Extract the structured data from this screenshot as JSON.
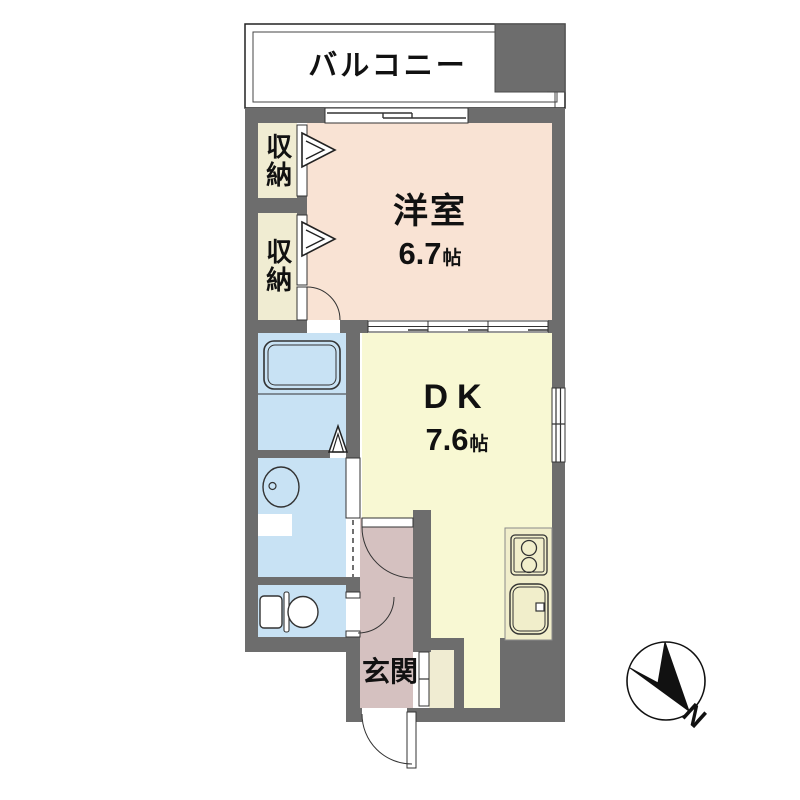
{
  "plan": {
    "type_note": "apartment floor plan",
    "balcony": {
      "label": "バルコニー"
    },
    "storage_top": {
      "label": "収納"
    },
    "storage_bottom": {
      "label": "収納"
    },
    "western_room": {
      "label": "洋室",
      "size_value": "6.7",
      "size_unit": "帖"
    },
    "dining_kitchen": {
      "label": "DK",
      "size_value": "7.6",
      "size_unit": "帖"
    },
    "entrance": {
      "label": "玄関"
    },
    "compass": {
      "north_label": "N"
    }
  },
  "colors": {
    "page-bg": "#ffffff",
    "wall": "#6d6d6d",
    "western-room": "#f9e3d4",
    "dk": "#f8f8d3",
    "closet": "#f0ecd2",
    "wet-area": "#c8e2f4",
    "entrance": "#d5c1c0",
    "counter": "#f1eecb",
    "outline": "#333333",
    "text": "#111111"
  }
}
